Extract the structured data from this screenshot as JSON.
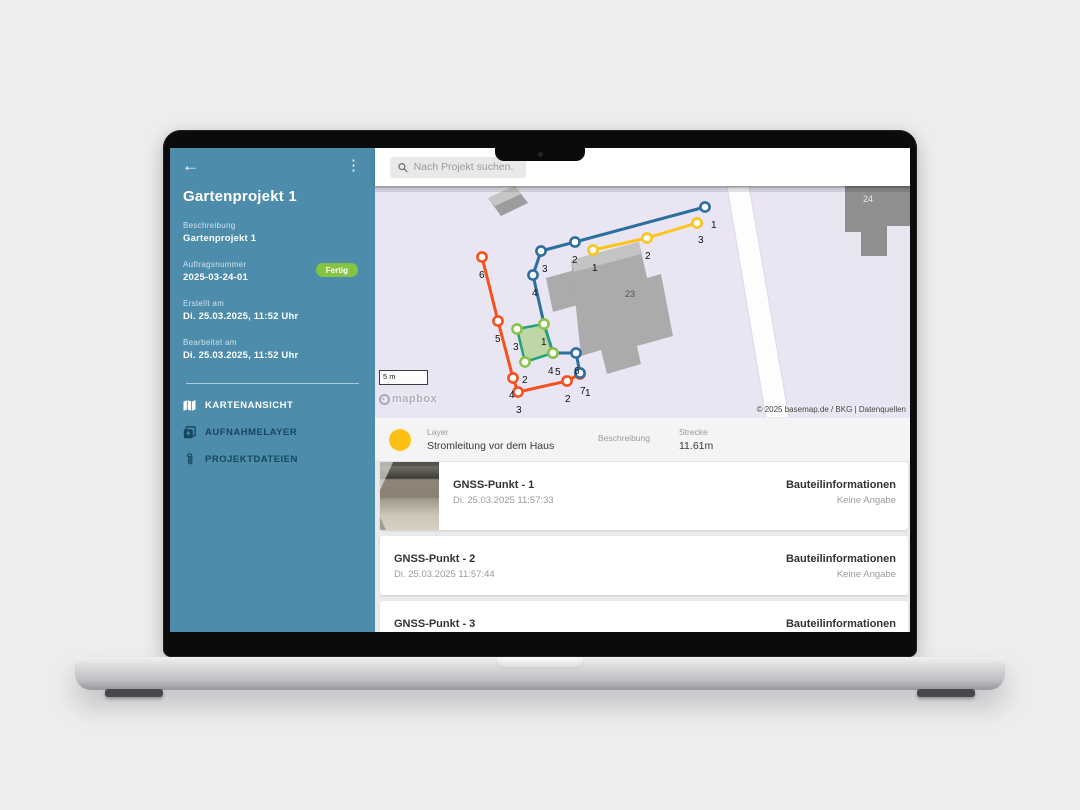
{
  "topbar": {
    "search_placeholder": "Nach Projekt suchen."
  },
  "sidebar": {
    "title": "Gartenprojekt 1",
    "fields": [
      {
        "label": "Beschreibung",
        "value": "Gartenprojekt 1"
      },
      {
        "label": "Auftragsnummer",
        "value": "2025-03-24-01",
        "badge": "Fertig"
      },
      {
        "label": "Erstellt am",
        "value": "Di. 25.03.2025, 11:52 Uhr"
      },
      {
        "label": "Bearbeitet am",
        "value": "Di. 25.03.2025, 11:52 Uhr"
      }
    ],
    "menu": [
      {
        "label": "KARTENANSICHT",
        "icon": "map-icon",
        "active": true
      },
      {
        "label": "AUFNAHMELAYER",
        "icon": "layers-add-icon",
        "active": false
      },
      {
        "label": "PROJEKTDATEIEN",
        "icon": "paperclip-icon",
        "active": false
      }
    ],
    "badge_color": "#85c441"
  },
  "map": {
    "scale_label": "5 m",
    "logo_text": "mapbox",
    "attribution": "© 2025 basemap.de / BKG | Datenquellen",
    "building_labels": [
      {
        "text": "23",
        "x": 250,
        "y": 111,
        "color": "#555555"
      },
      {
        "text": "24",
        "x": 488,
        "y": 16,
        "color": "#e8e8e8"
      }
    ],
    "lines": [
      {
        "name": "line-orange",
        "color": "#f4511e",
        "path": [
          [
            107,
            71
          ],
          [
            123,
            135
          ],
          [
            138,
            192
          ],
          [
            143,
            206
          ],
          [
            192,
            195
          ],
          [
            205,
            188
          ]
        ],
        "markers": [
          {
            "x": 107,
            "y": 71,
            "l": "6",
            "lx": 104,
            "ly": 85
          },
          {
            "x": 123,
            "y": 135,
            "l": "5",
            "lx": 120,
            "ly": 149
          },
          {
            "x": 138,
            "y": 192,
            "l": "4",
            "lx": 134,
            "ly": 205
          },
          {
            "x": 143,
            "y": 206,
            "l": "3",
            "lx": 141,
            "ly": 220
          },
          {
            "x": 192,
            "y": 195,
            "l": "2",
            "lx": 190,
            "ly": 209
          },
          {
            "x": 205,
            "y": 188,
            "l": "1",
            "lx": 210,
            "ly": 203
          }
        ]
      },
      {
        "name": "line-blue",
        "color": "#2c6e9e",
        "path": [
          [
            330,
            21
          ],
          [
            200,
            56
          ],
          [
            166,
            65
          ],
          [
            158,
            89
          ],
          [
            169,
            138
          ],
          [
            178,
            167
          ],
          [
            201,
            167
          ],
          [
            205,
            187
          ]
        ],
        "markers": [
          {
            "x": 330,
            "y": 21,
            "l": "1",
            "lx": 336,
            "ly": 35
          },
          {
            "x": 200,
            "y": 56,
            "l": "2",
            "lx": 197,
            "ly": 70
          },
          {
            "x": 166,
            "y": 65,
            "l": "3",
            "lx": 167,
            "ly": 79
          },
          {
            "x": 158,
            "y": 89,
            "l": "4",
            "lx": 157,
            "ly": 103
          },
          {
            "x": 178,
            "y": 167,
            "l": "5",
            "lx": 180,
            "ly": 182
          },
          {
            "x": 201,
            "y": 167,
            "l": "6",
            "lx": 199,
            "ly": 181
          },
          {
            "x": 205,
            "y": 187,
            "l": "7",
            "lx": 205,
            "ly": 201
          }
        ]
      },
      {
        "name": "line-yellow",
        "color": "#fcc419",
        "path": [
          [
            218,
            64
          ],
          [
            272,
            52
          ],
          [
            322,
            37
          ]
        ],
        "markers": [
          {
            "x": 218,
            "y": 64,
            "l": "1",
            "lx": 217,
            "ly": 78
          },
          {
            "x": 272,
            "y": 52,
            "l": "2",
            "lx": 270,
            "ly": 66
          },
          {
            "x": 322,
            "y": 37,
            "l": "3",
            "lx": 323,
            "ly": 50
          }
        ]
      }
    ],
    "polygon": {
      "name": "area-green",
      "stroke": "#27a27c",
      "marker": "#8bc34a",
      "fill": "rgba(139,195,74,0.45)",
      "path": [
        [
          142,
          143
        ],
        [
          169,
          138
        ],
        [
          178,
          167
        ],
        [
          150,
          176
        ]
      ],
      "markers": [
        {
          "x": 142,
          "y": 143,
          "l": "3",
          "lx": 138,
          "ly": 157
        },
        {
          "x": 169,
          "y": 138,
          "l": "1",
          "lx": 166,
          "ly": 152
        },
        {
          "x": 178,
          "y": 167,
          "l": "4",
          "lx": 173,
          "ly": 181
        },
        {
          "x": 150,
          "y": 176,
          "l": "2",
          "lx": 147,
          "ly": 190
        }
      ]
    }
  },
  "layer_info": {
    "dot_color": "#fcbf13",
    "layer_label": "Layer",
    "layer_value": "Stromleitung vor dem Haus",
    "description_label": "Beschreibung",
    "distance_label": "Strecke",
    "distance_value": "11.61m"
  },
  "points_list": [
    {
      "title": "GNSS-Punkt - 1",
      "timestamp": "Di. 25.03.2025 11:57:33",
      "info_label": "Bauteilinformationen",
      "info_value": "Keine Angabe"
    },
    {
      "title": "GNSS-Punkt - 2",
      "timestamp": "Di. 25.03.2025 11:57:44",
      "info_label": "Bauteilinformationen",
      "info_value": "Keine Angabe"
    },
    {
      "title": "GNSS-Punkt - 3",
      "timestamp": "",
      "info_label": "Bauteilinformationen",
      "info_value": ""
    }
  ]
}
